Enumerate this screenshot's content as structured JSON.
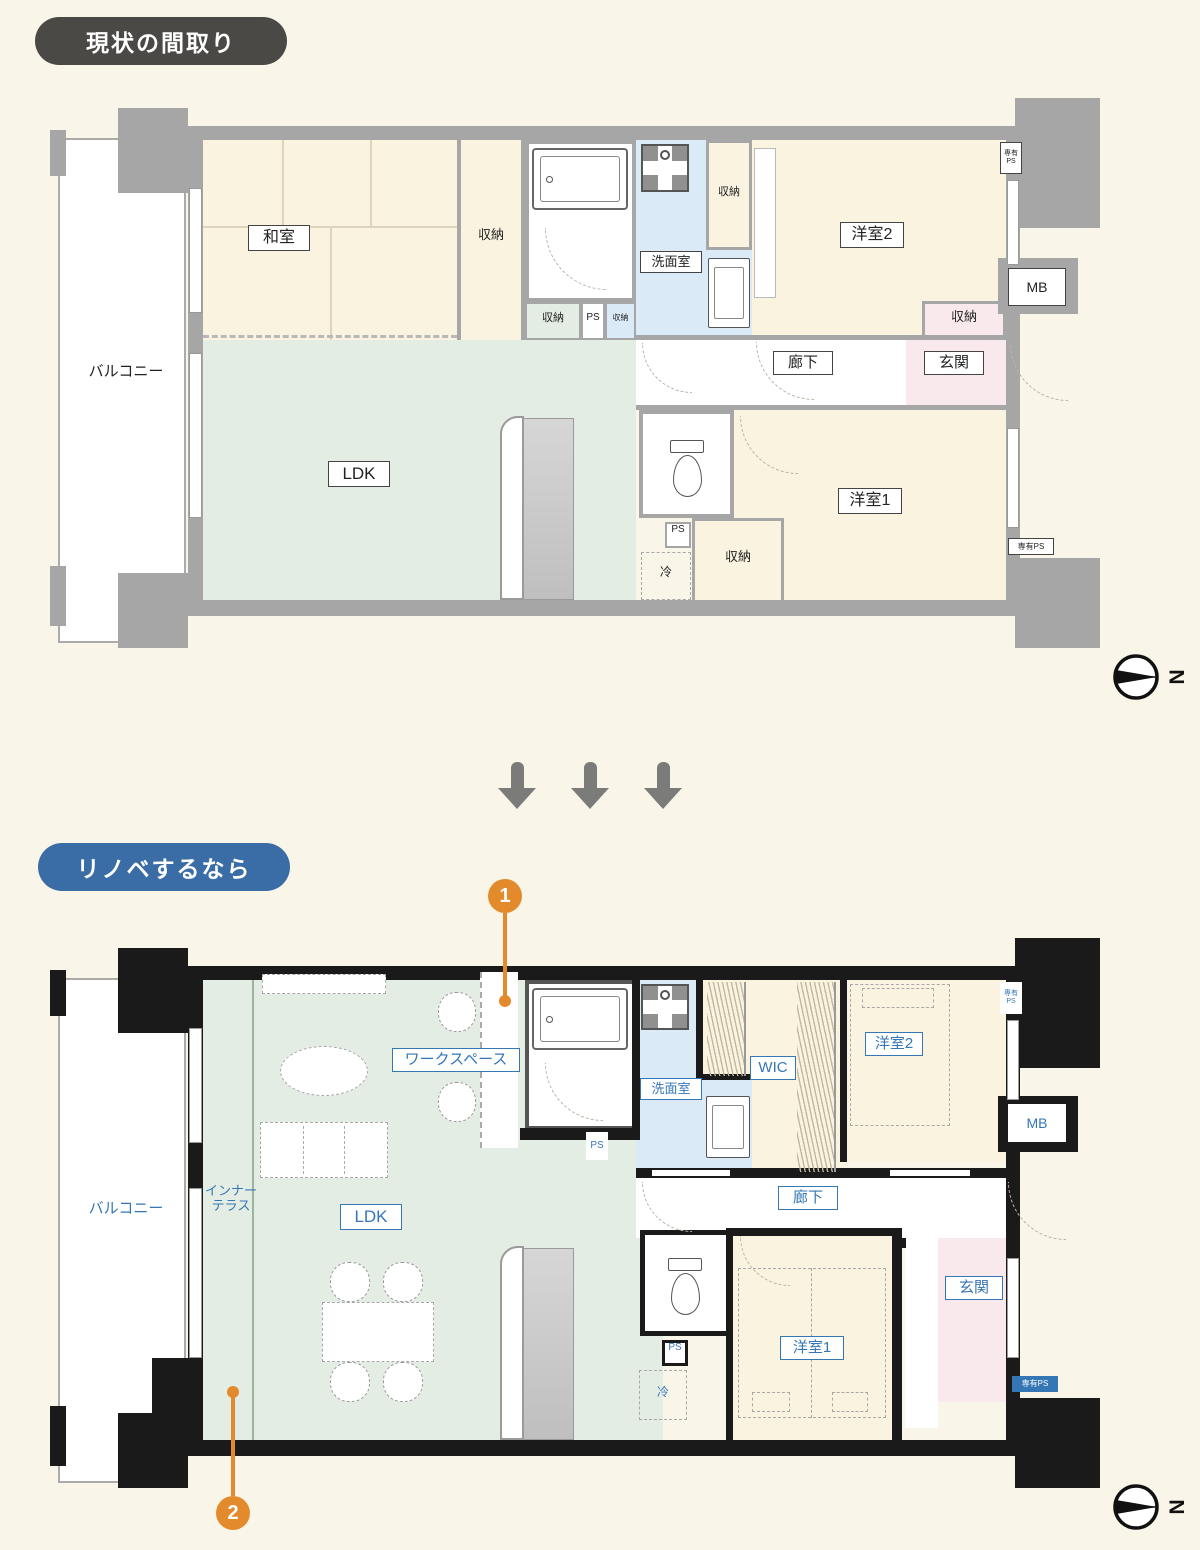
{
  "page": {
    "background": "#FAF5E9"
  },
  "current_plan": {
    "badge": "現状の間取り",
    "compass": "N",
    "labels": {
      "balcony": "バルコニー",
      "washitsu": "和室",
      "storage": "収納",
      "washroom": "洗面室",
      "ps": "PS",
      "private": "専有",
      "private_ps": "専有PS",
      "western2": "洋室2",
      "mb": "MB",
      "hallway": "廊下",
      "entrance": "玄関",
      "ldk": "LDK",
      "fridge": "冷",
      "western1": "洋室1"
    }
  },
  "reno_plan": {
    "badge": "リノベするなら",
    "compass": "N",
    "marker1": "1",
    "marker2": "2",
    "labels": {
      "balcony": "バルコニー",
      "inner_terrace_line1": "インナー",
      "inner_terrace_line2": "テラス",
      "ldk": "LDK",
      "workspace": "ワークスペース",
      "washroom": "洗面室",
      "ps": "PS",
      "private": "専有",
      "private_ps": "専有PS",
      "wic": "WIC",
      "western2": "洋室2",
      "mb": "MB",
      "hallway": "廊下",
      "entrance": "玄関",
      "fridge": "冷",
      "western1": "洋室1"
    }
  },
  "colors": {
    "background": "#FAF5E9",
    "wall_gray": "#A6A6A6",
    "wall_black": "#1A1A1A",
    "room_cream": "#FAF3DF",
    "ldk_green": "#E4EDE4",
    "washroom_blue": "#DAEAF7",
    "entrance_pink": "#F9E9EC",
    "label_blue": "#3576B5",
    "badge_gray": "#4B4946",
    "badge_blue": "#3A6CA5",
    "marker_orange": "#E38A2D",
    "arrow_gray": "#7B7B79"
  }
}
